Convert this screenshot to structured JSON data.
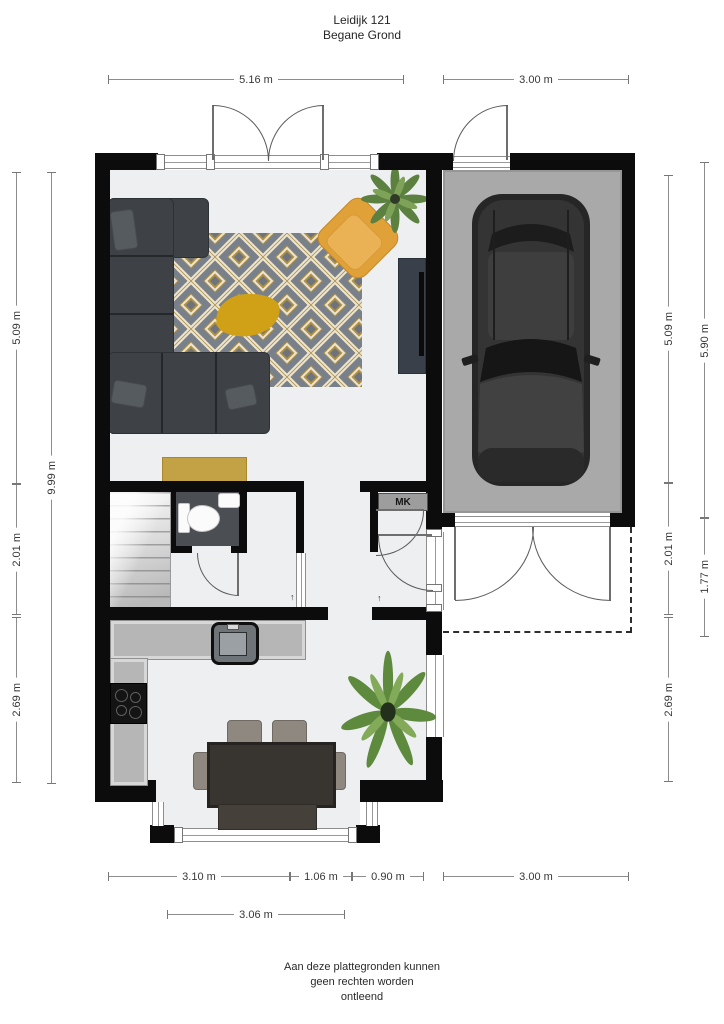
{
  "title": {
    "address": "Leidijk 121",
    "floor": "Begane Grond"
  },
  "labels": {
    "mk": "MK",
    "level_arrow": "↑"
  },
  "dims": {
    "top": [
      {
        "label": "5.16 m"
      },
      {
        "label": "3.00 m"
      }
    ],
    "bottom": [
      {
        "label": "3.10 m"
      },
      {
        "label": "1.06 m"
      },
      {
        "label": "0.90 m"
      },
      {
        "label": "3.00 m"
      }
    ],
    "bottom2": [
      {
        "label": "3.06 m"
      }
    ],
    "left_outer": [
      {
        "label": "5.09 m"
      },
      {
        "label": "2.01 m"
      },
      {
        "label": "2.69 m"
      }
    ],
    "left_inner": [
      {
        "label": "9.99 m"
      }
    ],
    "right_inner": [
      {
        "label": "5.09 m"
      },
      {
        "label": "2.01 m"
      },
      {
        "label": "2.69 m"
      }
    ],
    "right_outer": [
      {
        "label": "5.90 m"
      },
      {
        "label": "1.77 m"
      }
    ]
  },
  "disclaimer": {
    "line1": "Aan deze plattegronden kunnen",
    "line2": "geen rechten worden",
    "line3": "ontleend"
  },
  "colors": {
    "wall": "#0c0c0c",
    "floor": "#edeff1",
    "garage_floor": "#a9a9a9",
    "toilet_floor": "#4b4f53",
    "sofa": "#3e4246",
    "accent_yellow": "#e0a139",
    "rug_gold": "#b3913c",
    "rug_gray": "#78808c",
    "counter": "#b6b6b6"
  }
}
